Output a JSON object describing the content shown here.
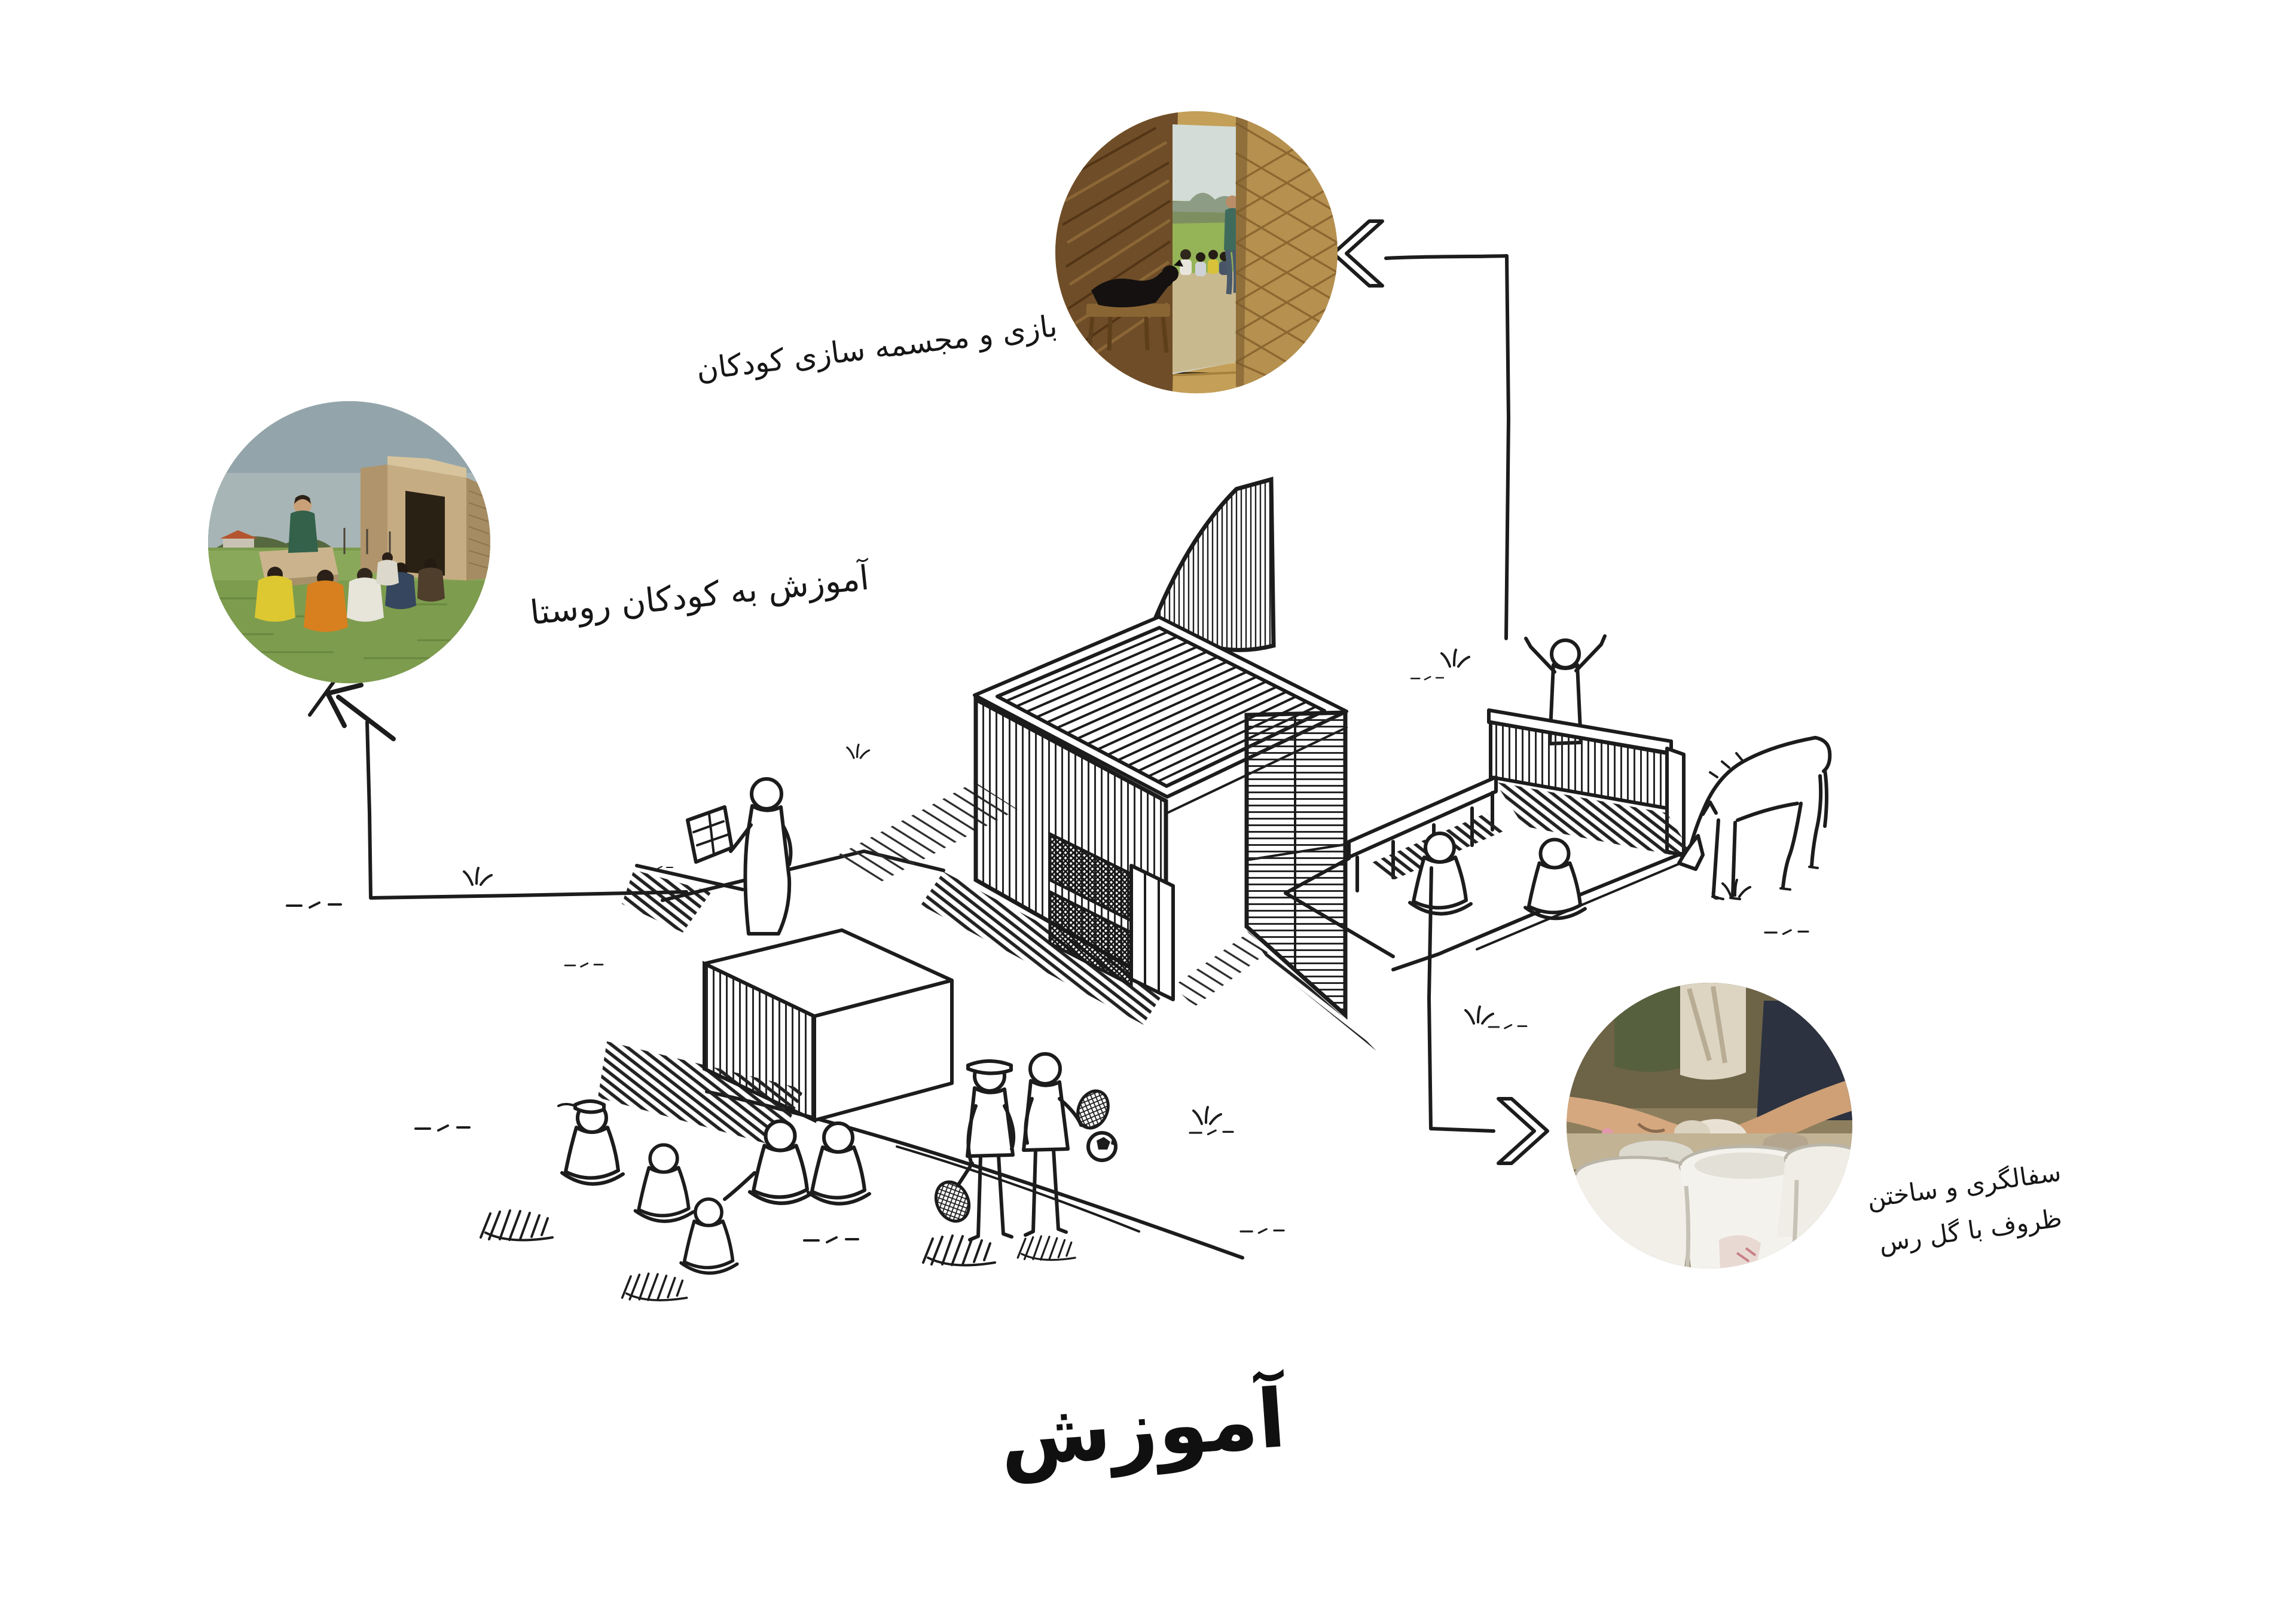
{
  "page": {
    "background": "#ffffff",
    "ink_color": "#1c1c1c"
  },
  "title": {
    "text": "آموزش"
  },
  "callouts": {
    "play": {
      "label": "بازی و مجسمه سازی کودکان"
    },
    "village": {
      "label": "آموزش به کودکان روستا"
    },
    "pottery": {
      "line1": "سفالگری و ساختن",
      "line2": "ظروف با گل رس"
    }
  }
}
